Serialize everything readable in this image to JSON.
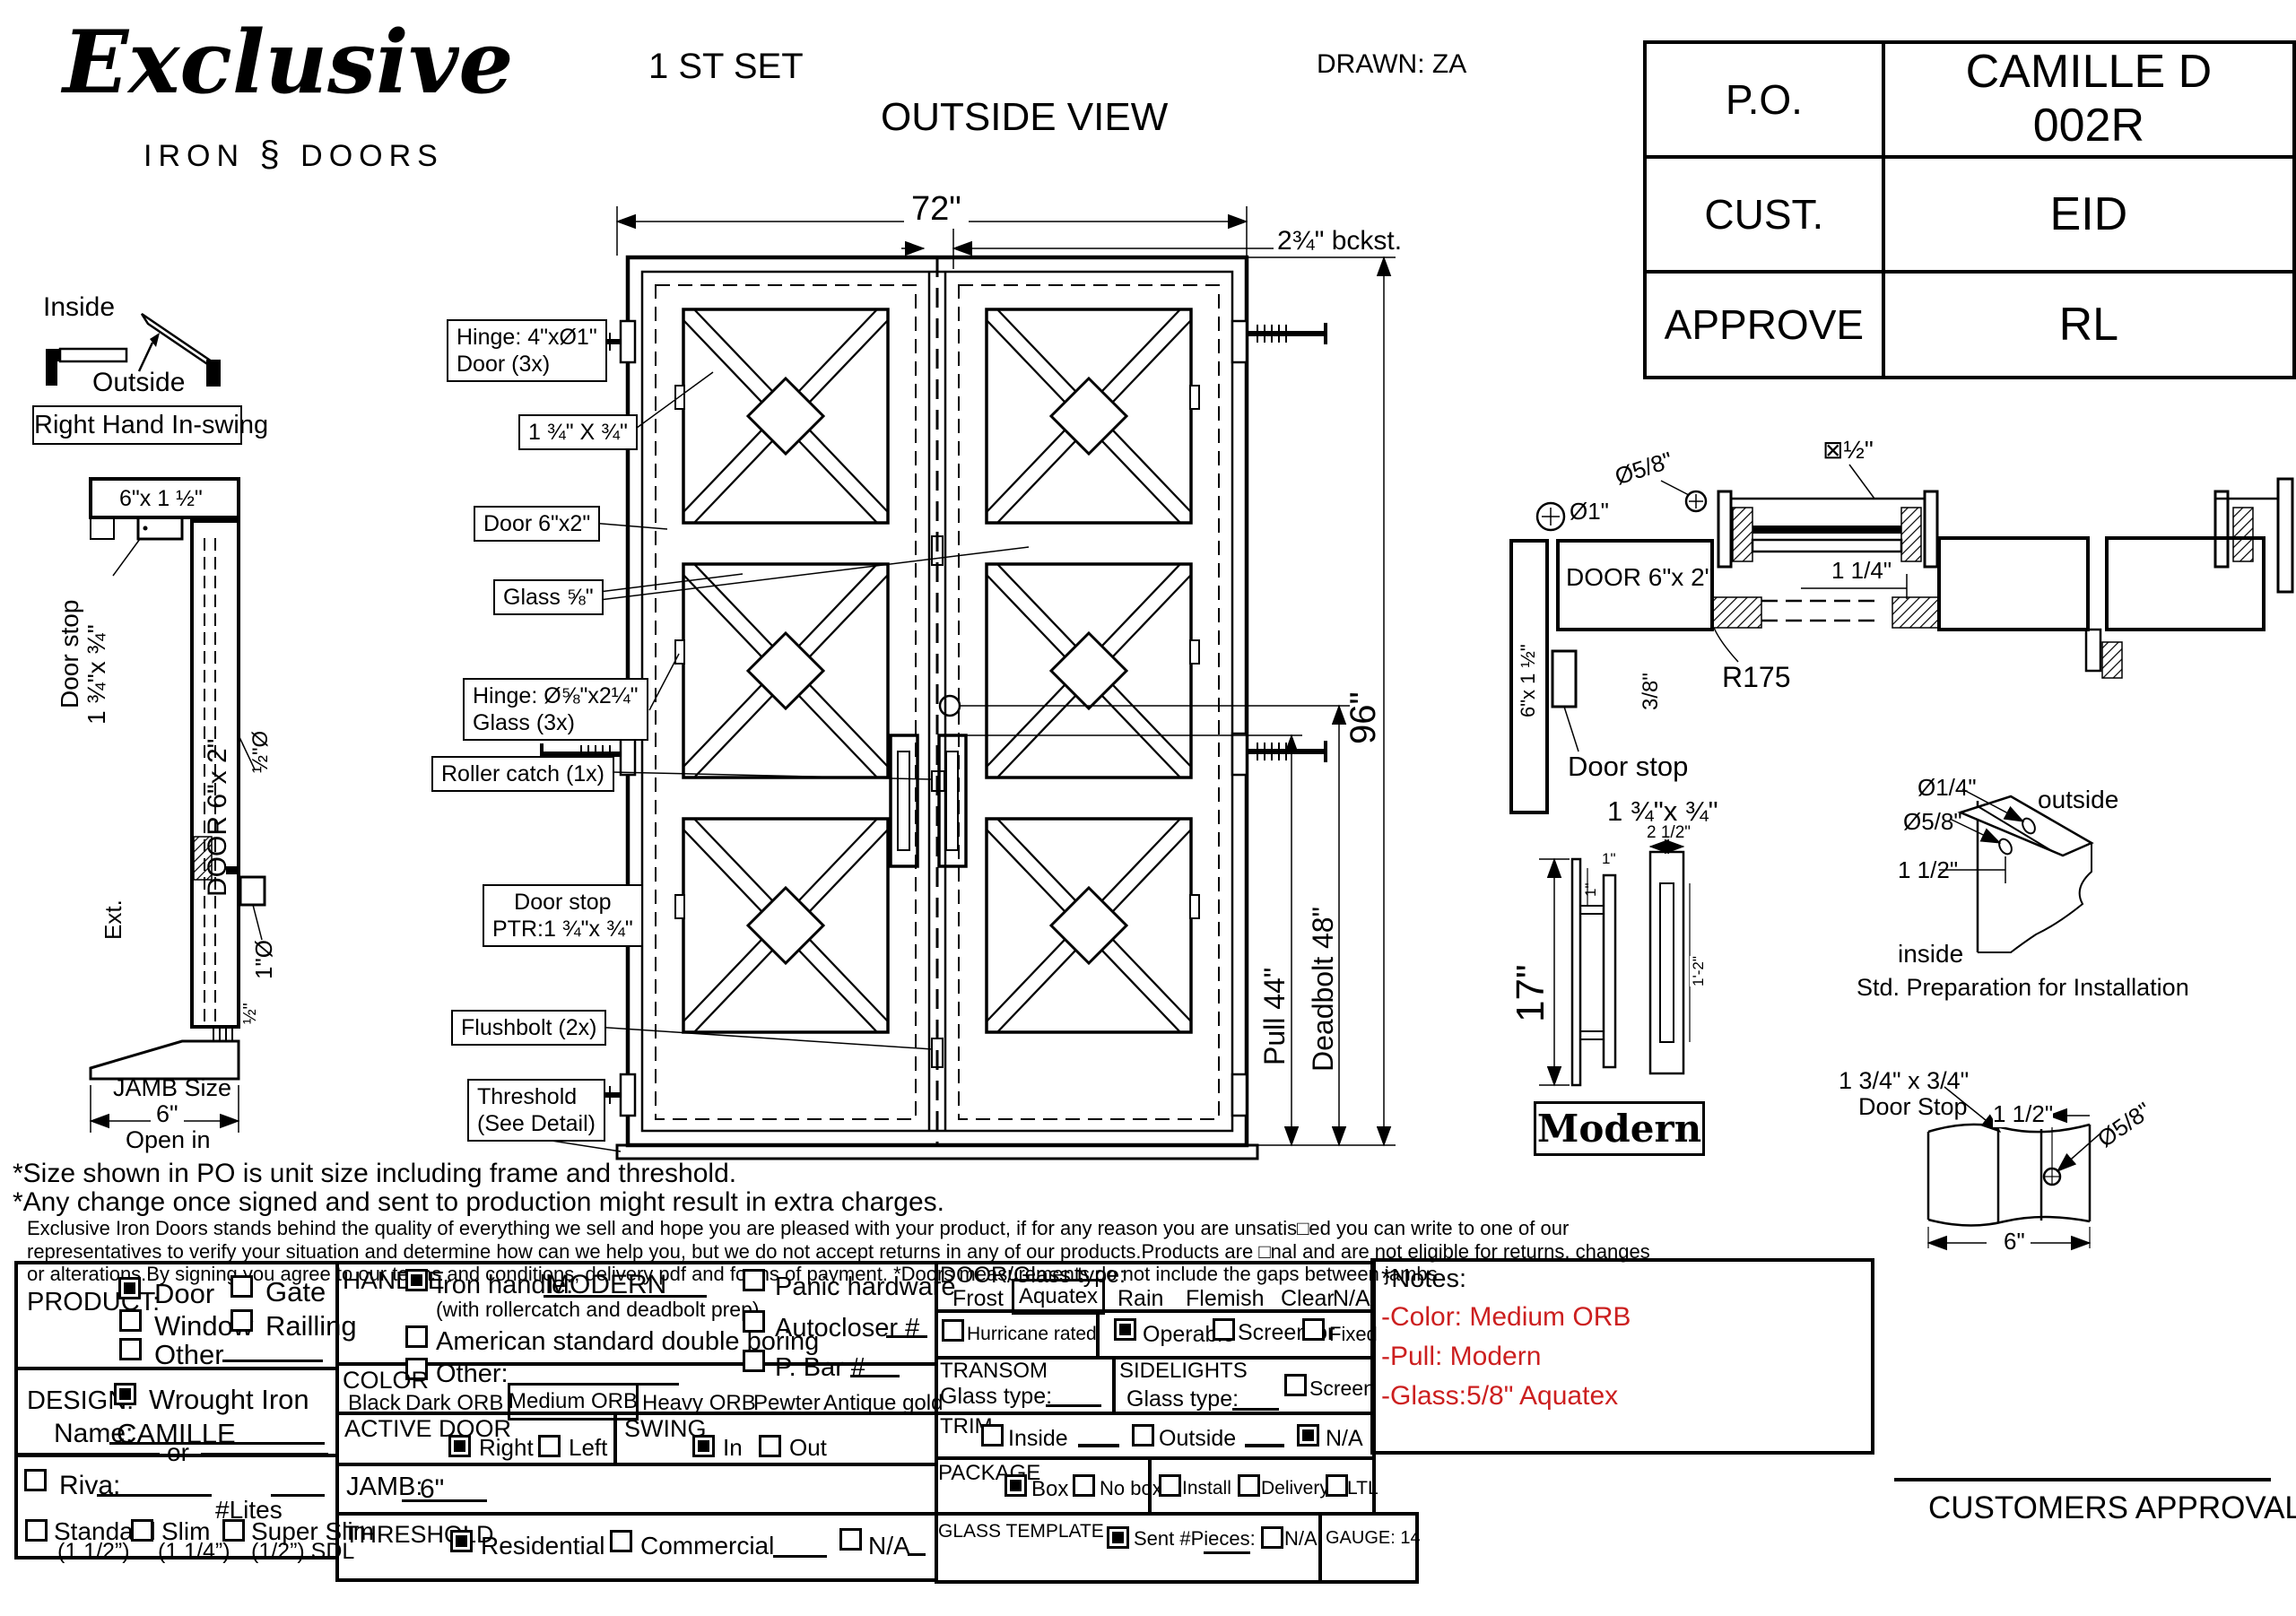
{
  "page": {
    "background": "#ffffff",
    "line_color": "#000000",
    "accent_red": "#cc1f1f"
  },
  "header": {
    "logo": {
      "script": "Exclusive",
      "iron": "IRON",
      "ornament": "§",
      "doors": "DOORS"
    },
    "set_label": "1 ST SET",
    "view_label": "OUTSIDE VIEW",
    "drawn_label": "DRAWN: ZA",
    "po_table": {
      "po_label": "P.O.",
      "po_value": "CAMILLE D 002R",
      "cust_label": "CUST.",
      "cust_value": "EID",
      "approve_label": "APPROVE",
      "approve_value": "RL"
    }
  },
  "swing_diagram": {
    "inside": "Inside",
    "outside": "Outside",
    "label": "Right Hand In-swing"
  },
  "jamb_section": {
    "header_dim": "6\"x 1 ½\"",
    "door_stop_1": "Door stop",
    "door_stop_2": "1 ¾\"x ¾\"",
    "door_label": "DOOR 6\"x 2\"",
    "ext": "Ext.",
    "dia_half": "½\"Ø",
    "dia_one": "1\"Ø",
    "half": "½\"",
    "jamb_size_1": "JAMB Size",
    "jamb_size_2": "6\"",
    "open_in": "Open in"
  },
  "elevation": {
    "dim_width": "72\"",
    "dim_backset": "2¾\" bckst.",
    "dim_height": "96\"",
    "dim_pull": "Pull 44\"",
    "dim_deadbolt": "Deadbolt 48\"",
    "callouts": {
      "hinge_door_1": "Hinge: 4\"xØ1\"",
      "hinge_door_2": "Door (3x)",
      "bar_dim": "1 ¾\" X ¾\"",
      "door_6x2": "Door 6\"x2\"",
      "glass": "Glass ⅝\"",
      "hinge_glass_1": "Hinge: Ø⅝\"x2¼\"",
      "hinge_glass_2": "Glass (3x)",
      "roller": "Roller catch  (1x)",
      "door_stop_1": "Door stop",
      "door_stop_2": "PTR:1 ¾\"x ¾\"",
      "flushbolt": "Flushbolt (2x)",
      "threshold_1": "Threshold",
      "threshold_2": "(See Detail)"
    }
  },
  "head_section": {
    "dia_one": "Ø1\"",
    "dia_58": "Ø5/8\"",
    "sq_half": "⊠½\"",
    "door_label": "DOOR 6\"x 2\"",
    "dim_114": "1 1/4\"",
    "r175": "R175",
    "dim_38": "3/8\"",
    "jamb_dim": "6\"x 1 ½\"",
    "door_stop_1": "Door stop",
    "door_stop_2": "1 ¾\"x ¾\""
  },
  "handle_detail": {
    "height": "17\"",
    "one_a": "1\"",
    "one_b": "1\"",
    "top_width": "2 1/2\"",
    "inner": "1'-2\"",
    "name": "Modern"
  },
  "install_detail": {
    "dia_14": "Ø1/4\"",
    "dia_58": "Ø5/8\"",
    "dim_112": "1 1/2\"",
    "outside": "outside",
    "inside": "inside",
    "caption": "Std. Preparation for Installation"
  },
  "doorstop_detail": {
    "size": "1 3/4\" x 3/4\"",
    "name": "Door Stop",
    "dim_112": "1 1/2\"",
    "dia_58": "Ø5/8\"",
    "dim_6": "6\""
  },
  "notes": {
    "star1": "*Size shown in PO is unit size including frame and threshold.",
    "star2": "*Any change once signed and sent to production might result in extra charges.",
    "para1": "Exclusive Iron Doors stands behind the quality of everything we sell and hope you are pleased with your product, if for any reason you are unsatis□ed you can write to one of our",
    "para2": "representatives to verify your situation and determine how can we help you, but we do not accept returns in any of our products.Products are □nal and are not eligible for returns, changes",
    "para3": "or alterations.By signing you agree to our terms and conditions, delivery pdf and forms of payment. *Doors measurements do not include the gaps between jambs"
  },
  "form": {
    "product": {
      "label": "PRODUCT:",
      "door": "Door",
      "gate": "Gate",
      "window": "Window",
      "railling": "Railling",
      "other": "Other"
    },
    "design": {
      "label": "DESIGN:",
      "wrought": "Wrought Iron",
      "name_label": "Name:",
      "name_value": "CAMILLE",
      "or": "or",
      "riva": "Riva:",
      "lites": "#Lites",
      "standard": "Standard",
      "standard_sub": "(1 1/2”)",
      "slim": "Slim",
      "slim_sub": "(1 1/4”)",
      "super_slim": "Super Slim",
      "super_slim_sub": "(1/2”) SDL"
    },
    "handle": {
      "label": "HANDLE",
      "iron": "Iron handle:",
      "iron_value": "MODERN",
      "iron_sub": "(with rollercatch and deadbolt prep)",
      "american": "American standard double boring",
      "other": "Other:",
      "panic": "Panic hardware",
      "autocloser": "Autocloser #",
      "pbar": "P. Bar #"
    },
    "color": {
      "label": "COLOR",
      "black": "Black",
      "dark": "Dark ORB",
      "medium": "Medium ORB",
      "heavy": "Heavy ORB",
      "pewter": "Pewter",
      "antique": "Antique gold"
    },
    "active_door": {
      "label": "ACTIVE DOOR",
      "right": "Right",
      "left": "Left"
    },
    "swing": {
      "label": "SWING",
      "in_": "In",
      "out": "Out"
    },
    "jamb": {
      "label": "JAMB:",
      "value": "6\""
    },
    "threshold": {
      "label": "THRESHOLD",
      "residential": "Residential",
      "commercial": "Commercial",
      "na": "N/A"
    },
    "glass": {
      "label": "DOOR/Glass type:",
      "frost": "Frost",
      "aquatex": "Aquatex",
      "rain": "Rain",
      "flemish": "Flemish",
      "clear": "Clear",
      "na": "N/A"
    },
    "options": {
      "hurricane": "Hurricane rated",
      "operable": "Operable",
      "screen_or": "Screen or",
      "fixed": "Fixed"
    },
    "transom": {
      "label": "TRANSOM",
      "glass_label": "Glass type:"
    },
    "sidelights": {
      "label": "SIDELIGHTS",
      "glass_label": "Glass type:",
      "screen": "Screen"
    },
    "trim": {
      "label": "TRIM",
      "inside": "Inside",
      "outside": "Outside",
      "na": "N/A"
    },
    "package": {
      "label": "PACKAGE",
      "box": "Box",
      "nobox": "No box",
      "install": "Install",
      "delivery": "Delivery",
      "ltl": "LTL"
    },
    "template": {
      "label": "GLASS TEMPLATE",
      "sent": "Sent #Pieces:",
      "na": "N/A",
      "gauge": "GAUGE: 14"
    },
    "notes_box": {
      "title": "*Notes:",
      "color": "-Color: Medium ORB",
      "pull": "-Pull: Modern",
      "glass": "-Glass:5/8\"   Aquatex"
    },
    "approval": "CUSTOMERS APPROVAL"
  }
}
